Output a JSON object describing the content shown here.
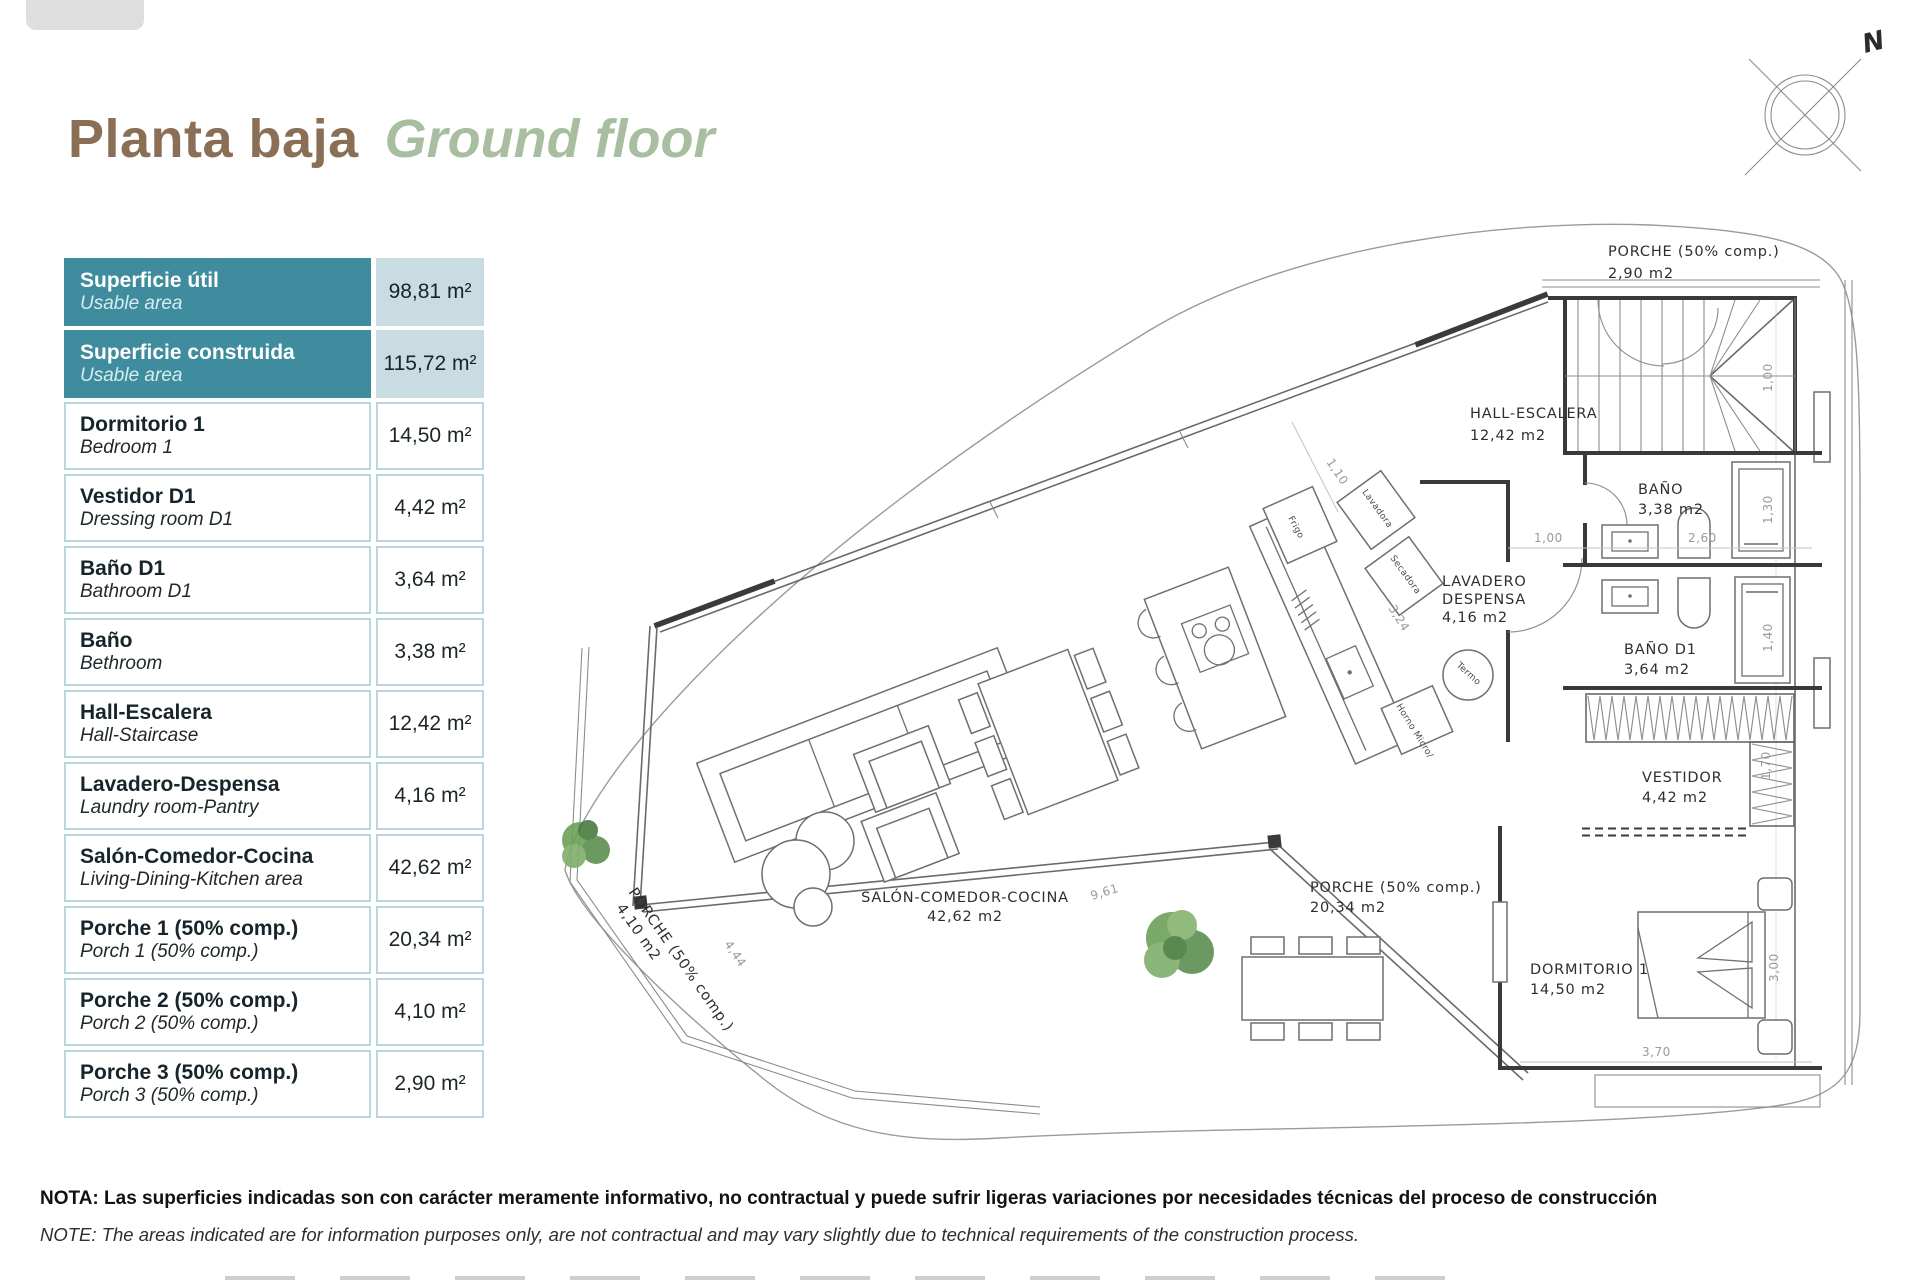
{
  "page": {
    "title_es": "Planta baja",
    "title_en": "Ground floor"
  },
  "colors": {
    "accent_teal": "#3e8c9d",
    "value_bg": "#c9dce1",
    "row_border": "#b9d8de",
    "title_brown": "#8a6e55",
    "title_green": "#a9bda0",
    "tree_green": "#5c8f4e"
  },
  "table": {
    "rows": [
      {
        "es": "Superficie útil",
        "en": "Usable area",
        "value": "98,81 m²"
      },
      {
        "es": "Superficie construida",
        "en": "Usable area",
        "value": "115,72 m²"
      },
      {
        "es": "Dormitorio 1",
        "en": "Bedroom 1",
        "value": "14,50 m²"
      },
      {
        "es": "Vestidor D1",
        "en": "Dressing room D1",
        "value": "4,42 m²"
      },
      {
        "es": "Baño D1",
        "en": "Bathroom D1",
        "value": "3,64 m²"
      },
      {
        "es": "Baño",
        "en": "Bethroom",
        "value": "3,38 m²"
      },
      {
        "es": "Hall-Escalera",
        "en": "Hall-Staircase",
        "value": "12,42 m²"
      },
      {
        "es": "Lavadero-Despensa",
        "en": "Laundry room-Pantry",
        "value": "4,16 m²"
      },
      {
        "es": "Salón-Comedor-Cocina",
        "en": "Living-Dining-Kitchen area",
        "value": "42,62 m²"
      },
      {
        "es": "Porche 1 (50% comp.)",
        "en": "Porch 1 (50% comp.)",
        "value": "20,34 m²"
      },
      {
        "es": "Porche 2 (50% comp.)",
        "en": "Porch 2 (50% comp.)",
        "value": "4,10 m²"
      },
      {
        "es": "Porche 3 (50% comp.)",
        "en": "Porch 3 (50% comp.)",
        "value": "2,90 m²"
      }
    ]
  },
  "note": {
    "line1": "NOTA: Las superficies indicadas son con carácter meramente informativo, no contractual y puede sufrir ligeras variaciones por necesidades técnicas del proceso de construcción",
    "line2": "NOTE: The areas indicated are for information purposes only, are not contractual and may vary slightly due to technical requirements of the construction process."
  },
  "compass": {
    "label": "N"
  },
  "plan": {
    "labels": {
      "porche3": {
        "l1": "PORCHE (50% comp.)",
        "l2": "2,90 m2"
      },
      "hall": {
        "l1": "HALL-ESCALERA",
        "l2": "12,42 m2"
      },
      "bano": {
        "l1": "BAÑO",
        "l2": "3,38 m2"
      },
      "lavadero": {
        "l1": "LAVADERO",
        "l2": "DESPENSA",
        "l3": "4,16 m2"
      },
      "bano_d1": {
        "l1": "BAÑO D1",
        "l2": "3,64 m2"
      },
      "vestidor": {
        "l1": "VESTIDOR",
        "l2": "4,42 m2"
      },
      "salon": {
        "l1": "SALÓN-COMEDOR-COCINA",
        "l2": "42,62 m2"
      },
      "porche1": {
        "l1": "PORCHE (50% comp.)",
        "l2": "20,34 m2"
      },
      "porche2": {
        "l1": "PORCHE (50% comp.)",
        "l2": "4,10 m2"
      },
      "dormitorio": {
        "l1": "DORMITORIO 1",
        "l2": "14,50 m2"
      }
    },
    "appliances": {
      "frigo": "Frigo",
      "lavadora": "Lavadora",
      "secadora": "Secadora",
      "termo": "Termo",
      "horno": "Horno Micro/"
    },
    "dims": {
      "d110": "1,10",
      "d324": "3,24",
      "d100_stairs": "1,00",
      "d100_hall": "1,00",
      "d260": "2,60",
      "d130": "1,30",
      "d140": "1,40",
      "d170": "1,70",
      "d300": "3,00",
      "d370": "3,70",
      "d961": "9,61",
      "d444": "4,44"
    }
  }
}
